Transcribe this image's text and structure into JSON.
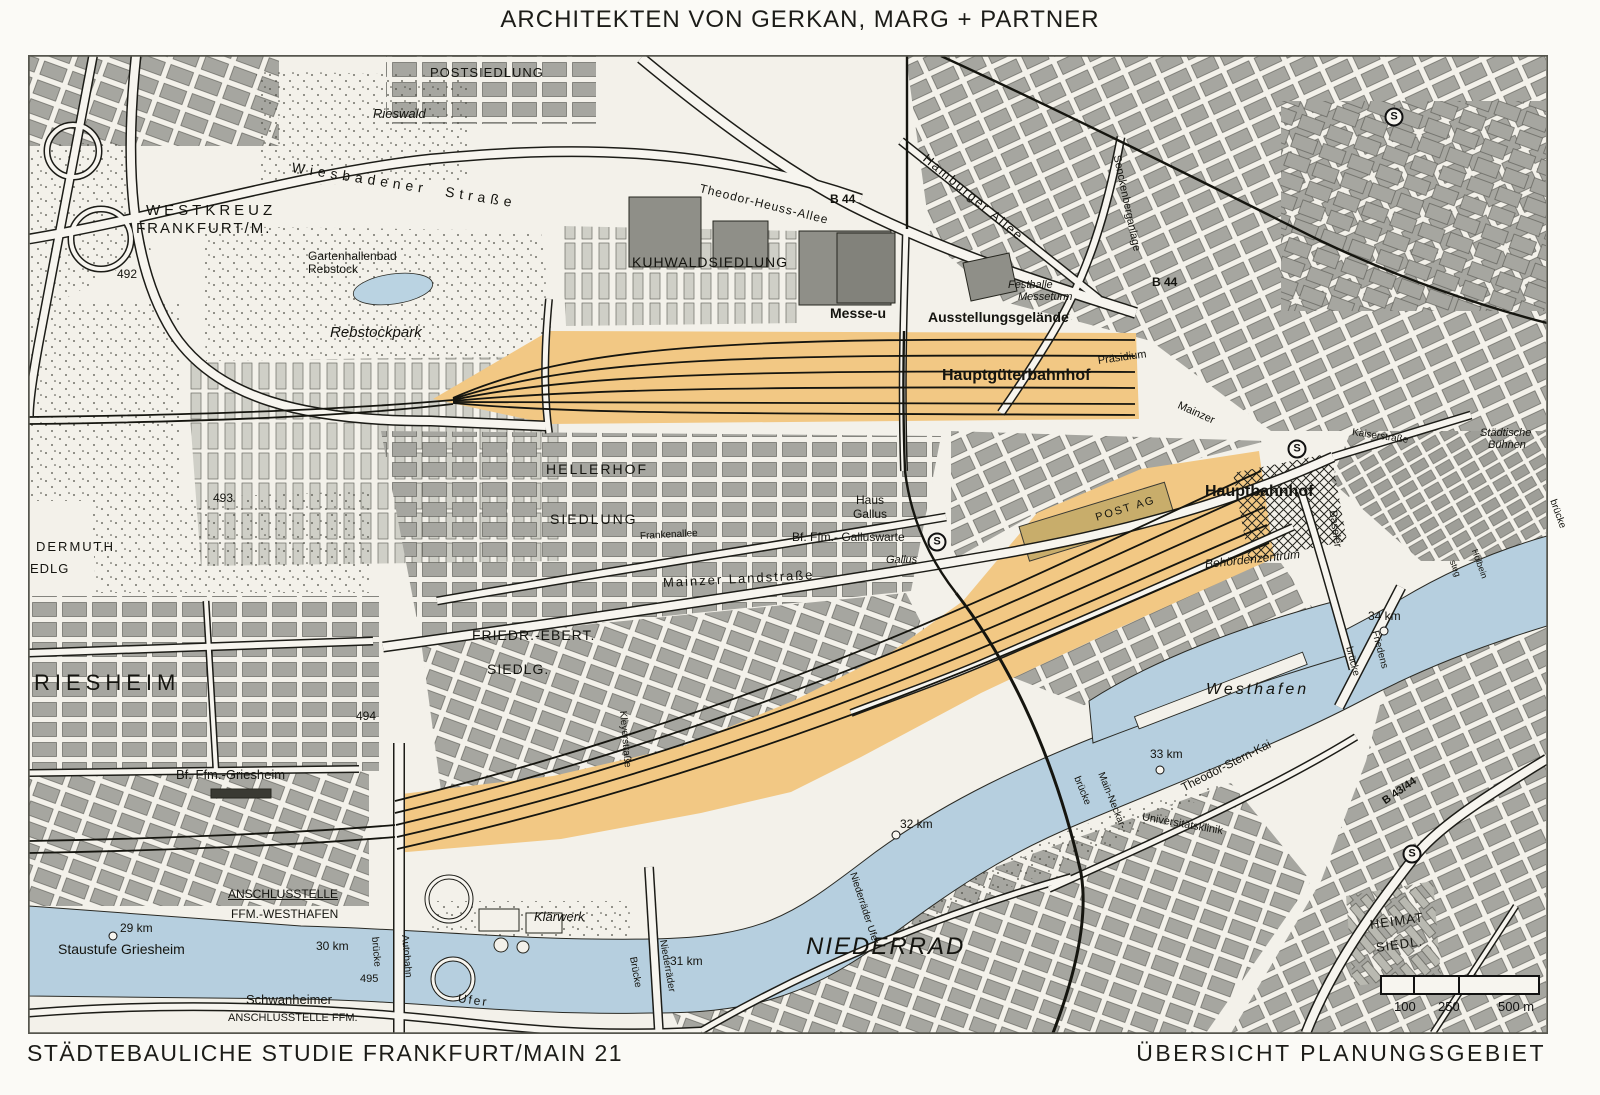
{
  "header": {
    "title": "ARCHITEKTEN VON GERKAN, MARG + PARTNER"
  },
  "footer": {
    "left": "STÄDTEBAULICHE STUDIE FRANKFURT/MAIN 21",
    "right": "ÜBERSICHT PLANUNGSGEBIET"
  },
  "map": {
    "colors": {
      "paper": "#f3f1ea",
      "block_gray": "#a6a6a0",
      "hall_gray": "#8f8f88",
      "water_blue": "#b6cfdf",
      "plan_orange": "#f2c884",
      "plan_building_tan": "#c8ad6b",
      "line_black": "#1c1c17"
    },
    "s_symbol": "S",
    "scale_bar": {
      "t100": "100",
      "t250": "250",
      "t500": "500 m"
    },
    "s_stations": [
      {
        "x": 937,
        "y": 542
      },
      {
        "x": 1297,
        "y": 449
      },
      {
        "x": 1394,
        "y": 117
      },
      {
        "x": 1412,
        "y": 854
      }
    ],
    "km_dots": [
      {
        "x": 113,
        "y": 936
      },
      {
        "x": 896,
        "y": 835
      },
      {
        "x": 1160,
        "y": 770
      },
      {
        "x": 1384,
        "y": 631
      }
    ],
    "labels": [
      {
        "t": "WESTKREUZ",
        "x": 146,
        "y": 203,
        "s": 15,
        "sp": 4
      },
      {
        "t": "FRANKFURT/M.",
        "x": 136,
        "y": 221,
        "s": 15,
        "sp": 2
      },
      {
        "t": "Wiesbadener  Straße",
        "x": 292,
        "y": 160,
        "s": 14,
        "sp": 5,
        "r": 9
      },
      {
        "t": "492",
        "x": 117,
        "y": 268,
        "s": 12
      },
      {
        "t": "Gartenhallenbad",
        "x": 308,
        "y": 250,
        "s": 12
      },
      {
        "t": "Rebstock",
        "x": 308,
        "y": 263,
        "s": 12
      },
      {
        "t": "Rebstockpark",
        "x": 330,
        "y": 325,
        "s": 15,
        "i": 1
      },
      {
        "t": "POSTSIEDLUNG",
        "x": 430,
        "y": 66,
        "s": 13,
        "sp": 1
      },
      {
        "t": "Rieswald",
        "x": 373,
        "y": 107,
        "s": 13,
        "i": 1
      },
      {
        "t": "KUHWALDSIEDLUNG",
        "x": 632,
        "y": 255,
        "s": 14,
        "sp": 1
      },
      {
        "t": "Messe-u",
        "x": 830,
        "y": 306,
        "s": 14,
        "b": 1
      },
      {
        "t": "Ausstellungsgelände",
        "x": 928,
        "y": 310,
        "s": 14,
        "b": 1
      },
      {
        "t": "Festhalle",
        "x": 1008,
        "y": 280,
        "s": 11,
        "i": 1
      },
      {
        "t": "Messeturm",
        "x": 1018,
        "y": 292,
        "s": 11,
        "i": 1
      },
      {
        "t": "Hauptgüterbahnhof",
        "x": 942,
        "y": 368,
        "s": 16,
        "b": 1
      },
      {
        "t": "Präsidium",
        "x": 1098,
        "y": 356,
        "s": 11,
        "r": -8
      },
      {
        "t": "Hamburger Allee",
        "x": 925,
        "y": 150,
        "s": 13,
        "sp": 2,
        "r": 40
      },
      {
        "t": "Senckenberganlage",
        "x": 1116,
        "y": 150,
        "s": 11,
        "r": 78
      },
      {
        "t": "B 44",
        "x": 830,
        "y": 193,
        "s": 12,
        "b": 1
      },
      {
        "t": "B 44",
        "x": 1152,
        "y": 276,
        "s": 12,
        "b": 1
      },
      {
        "t": "Theodor-Heuss-Allee",
        "x": 700,
        "y": 182,
        "s": 12,
        "sp": 1,
        "r": 14
      },
      {
        "t": "HELLERHOF",
        "x": 546,
        "y": 462,
        "s": 14,
        "sp": 2
      },
      {
        "t": "SIEDLUNG",
        "x": 550,
        "y": 512,
        "s": 14,
        "sp": 2
      },
      {
        "t": "Haus",
        "x": 856,
        "y": 494,
        "s": 12
      },
      {
        "t": "Gallus",
        "x": 853,
        "y": 508,
        "s": 12
      },
      {
        "t": "Bf. Ffm.- Galluswarte",
        "x": 792,
        "y": 531,
        "s": 12
      },
      {
        "t": "Gallus",
        "x": 886,
        "y": 555,
        "s": 11,
        "i": 1
      },
      {
        "t": "Frankenallee",
        "x": 640,
        "y": 532,
        "s": 10,
        "r": -3
      },
      {
        "t": "Mainzer Landstraße",
        "x": 663,
        "y": 576,
        "s": 13,
        "sp": 2,
        "r": -3
      },
      {
        "t": "Mainzer",
        "x": 1178,
        "y": 400,
        "s": 11,
        "r": 24
      },
      {
        "t": "Kaiserstraße",
        "x": 1352,
        "y": 428,
        "s": 10,
        "r": 8
      },
      {
        "t": "Städtische",
        "x": 1480,
        "y": 428,
        "s": 11,
        "i": 1
      },
      {
        "t": "Bühnen",
        "x": 1488,
        "y": 440,
        "s": 11,
        "i": 1
      },
      {
        "t": "Hauptbahnhof",
        "x": 1205,
        "y": 484,
        "s": 16,
        "b": 1
      },
      {
        "t": "Baseler",
        "x": 1332,
        "y": 505,
        "s": 11,
        "r": 82
      },
      {
        "t": "brücke",
        "x": 1552,
        "y": 495,
        "s": 10,
        "r": 70
      },
      {
        "t": "POST AG",
        "x": 1096,
        "y": 513,
        "s": 11,
        "sp": 2,
        "r": -17
      },
      {
        "t": "Behördenzentrum",
        "x": 1205,
        "y": 558,
        "s": 12,
        "i": 1,
        "r": -6
      },
      {
        "t": "FRIEDR.-EBERT.",
        "x": 472,
        "y": 628,
        "s": 14,
        "sp": 1
      },
      {
        "t": "SIEDLG.",
        "x": 487,
        "y": 662,
        "s": 14,
        "sp": 1
      },
      {
        "t": "493",
        "x": 213,
        "y": 492,
        "s": 12
      },
      {
        "t": "DERMUTH",
        "x": 36,
        "y": 540,
        "s": 13,
        "sp": 2
      },
      {
        "t": "EDLG",
        "x": 30,
        "y": 562,
        "s": 13,
        "sp": 1
      },
      {
        "t": "RIESHEIM",
        "x": 34,
        "y": 672,
        "s": 22,
        "sp": 5
      },
      {
        "t": "494",
        "x": 356,
        "y": 710,
        "s": 12
      },
      {
        "t": "Bf. Ffm.-Griesheim",
        "x": 176,
        "y": 768,
        "s": 13
      },
      {
        "t": "ANSCHLUSSTELLE",
        "x": 228,
        "y": 888,
        "s": 12,
        "u": 1
      },
      {
        "t": "FFM.-WESTHAFEN",
        "x": 231,
        "y": 908,
        "s": 12
      },
      {
        "t": "29 km",
        "x": 120,
        "y": 922,
        "s": 12
      },
      {
        "t": "Staustufe Griesheim",
        "x": 58,
        "y": 942,
        "s": 14
      },
      {
        "t": "30 km",
        "x": 316,
        "y": 940,
        "s": 12
      },
      {
        "t": "495",
        "x": 360,
        "y": 974,
        "s": 11
      },
      {
        "t": "Schwanheimer",
        "x": 246,
        "y": 993,
        "s": 13
      },
      {
        "t": "ANSCHLUSSTELLE FFM.",
        "x": 228,
        "y": 1013,
        "s": 11
      },
      {
        "t": "Autobahn",
        "x": 404,
        "y": 930,
        "s": 10,
        "r": 85
      },
      {
        "t": "brücke",
        "x": 374,
        "y": 932,
        "s": 10,
        "r": 85
      },
      {
        "t": "Ufer",
        "x": 458,
        "y": 992,
        "s": 12,
        "sp": 2,
        "r": 8
      },
      {
        "t": "Klärwerk",
        "x": 534,
        "y": 910,
        "s": 13,
        "i": 1
      },
      {
        "t": "Kleyerstraße",
        "x": 622,
        "y": 706,
        "s": 10,
        "r": 85
      },
      {
        "t": "Niederräder",
        "x": 662,
        "y": 935,
        "s": 10,
        "r": 80
      },
      {
        "t": "Brücke",
        "x": 632,
        "y": 952,
        "s": 10,
        "r": 80
      },
      {
        "t": "31 km",
        "x": 670,
        "y": 955,
        "s": 12
      },
      {
        "t": "NIEDERRAD",
        "x": 806,
        "y": 935,
        "s": 24,
        "i": 1,
        "sp": 2
      },
      {
        "t": "Niederräder Ufer",
        "x": 852,
        "y": 868,
        "s": 10,
        "r": 72
      },
      {
        "t": "32 km",
        "x": 900,
        "y": 818,
        "s": 12
      },
      {
        "t": "Main-Neckar-",
        "x": 1100,
        "y": 768,
        "s": 10,
        "r": 68
      },
      {
        "t": "brücke",
        "x": 1076,
        "y": 772,
        "s": 10,
        "r": 68
      },
      {
        "t": "Universitätsklinik",
        "x": 1142,
        "y": 812,
        "s": 11,
        "r": 10
      },
      {
        "t": "Westhafen",
        "x": 1206,
        "y": 682,
        "s": 16,
        "i": 1,
        "sp": 3
      },
      {
        "t": "33 km",
        "x": 1150,
        "y": 748,
        "s": 12
      },
      {
        "t": "Theodor-Stern-Kai",
        "x": 1182,
        "y": 782,
        "s": 12,
        "r": -27
      },
      {
        "t": "B 43/44",
        "x": 1384,
        "y": 797,
        "s": 11,
        "b": 1,
        "r": -35
      },
      {
        "t": "Friedens",
        "x": 1374,
        "y": 626,
        "s": 10,
        "r": 75
      },
      {
        "t": "brücke",
        "x": 1348,
        "y": 642,
        "s": 10,
        "r": 75
      },
      {
        "t": "34 km",
        "x": 1368,
        "y": 610,
        "s": 12
      },
      {
        "t": "Holbein",
        "x": 1474,
        "y": 545,
        "s": 9,
        "r": 70
      },
      {
        "t": "steg",
        "x": 1452,
        "y": 556,
        "s": 9,
        "r": 70
      },
      {
        "t": "HEIMAT",
        "x": 1370,
        "y": 918,
        "s": 13,
        "sp": 1,
        "r": -8
      },
      {
        "t": "SIEDL.",
        "x": 1376,
        "y": 941,
        "s": 13,
        "sp": 1,
        "r": -8
      }
    ]
  }
}
